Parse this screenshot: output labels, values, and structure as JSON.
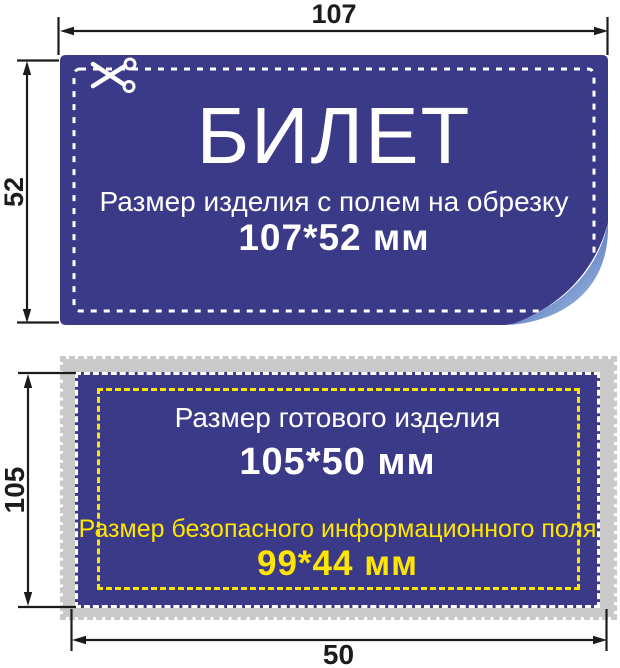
{
  "diagram": {
    "top_card": {
      "width_label": "107",
      "height_label": "52",
      "title": "БИЛЕТ",
      "subtitle": "Размер изделия с полем на обрезку",
      "size_text": "107*52 мм"
    },
    "bottom_card": {
      "height_label": "105",
      "width_label": "50",
      "finished_size_caption": "Размер готового изделия",
      "finished_size_text": "105*50 мм",
      "safe_area_caption": "Размер безопасного информационного поля",
      "safe_area_text": "99*44 мм"
    },
    "icons": {
      "scissors": "scissors-icon"
    },
    "colors": {
      "card_blue": "#3a3a88",
      "bleed_gray": "#c9c9c9",
      "safe_yellow": "#ffe600",
      "dimension_black": "#1c1c1c",
      "dash_white": "#ffffff",
      "curl_dark": "#47629f",
      "curl_light": "#a3bce4"
    }
  }
}
